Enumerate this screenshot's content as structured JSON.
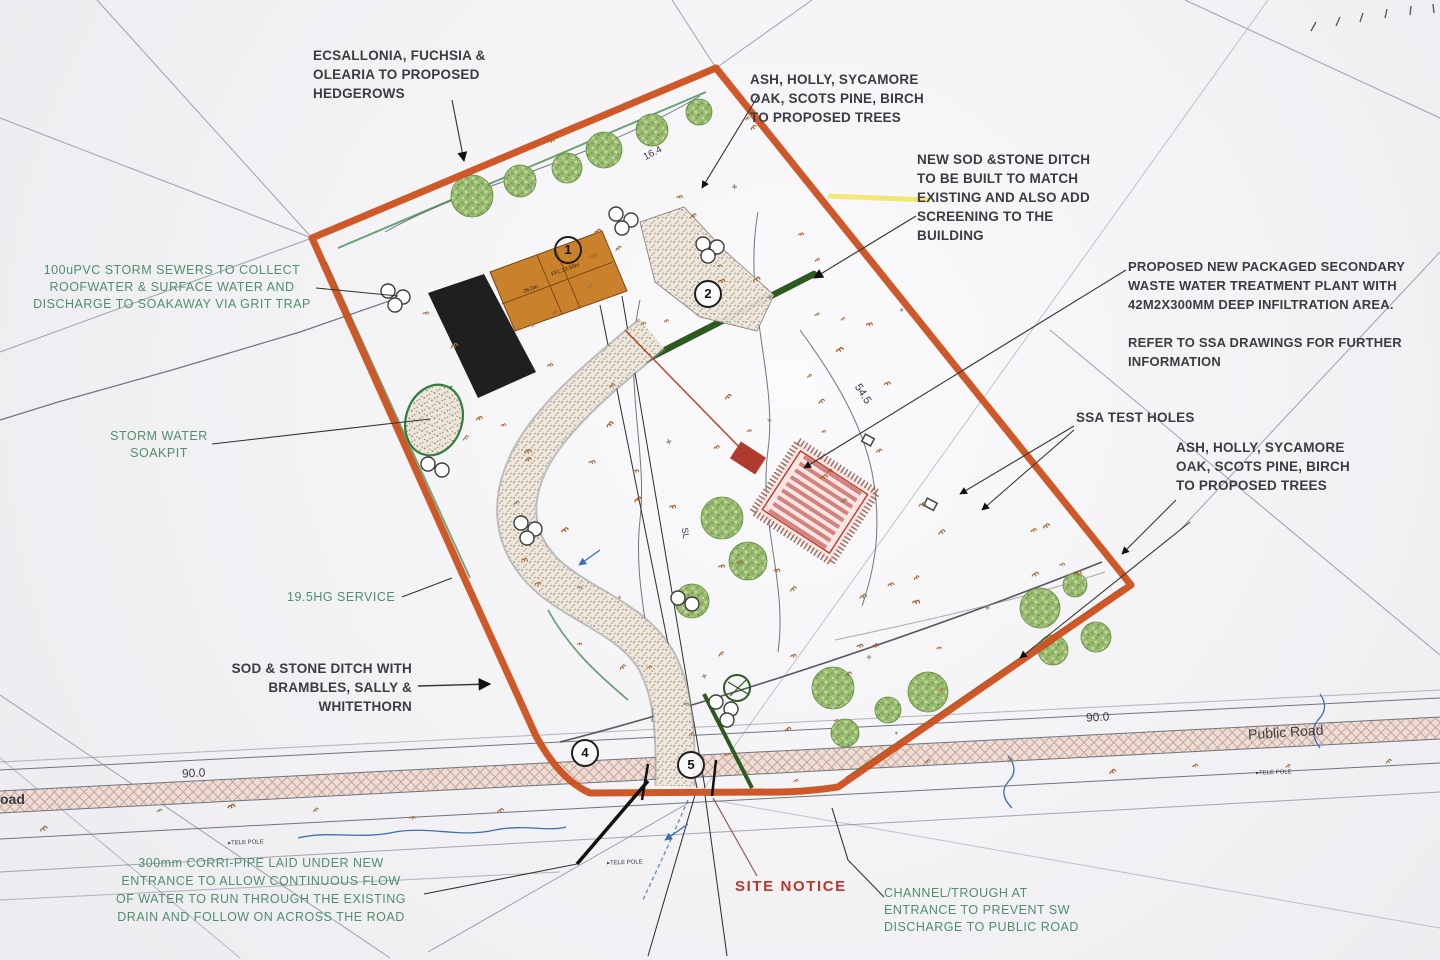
{
  "drawing": {
    "notes": {
      "hedgerows": "ECSALLONIA, FUCHSIA &\nOLEARIA TO PROPOSED\nHEDGEROWS",
      "trees_top": "ASH, HOLLY, SYCAMORE\nOAK, SCOTS PINE, BIRCH\nTO PROPOSED TREES",
      "new_sod_stone_ditch": "NEW SOD &STONE DITCH\nTO BE BUILT TO MATCH\nEXISTING AND ALSO ADD\nSCREENING TO THE\nBUILDING",
      "treatment_plant": "PROPOSED NEW PACKAGED SECONDARY\nWASTE WATER TREATMENT PLANT WITH\n42M2X300MM DEEP INFILTRATION AREA.\n\nREFER TO SSA DRAWINGS FOR FURTHER\nINFORMATION",
      "ssa_test_holes": "SSA TEST HOLES",
      "trees_right": "ASH, HOLLY, SYCAMORE\nOAK, SCOTS PINE, BIRCH\nTO PROPOSED TREES",
      "storm_sewers": "100uPVC STORM SEWERS TO COLLECT\nROOFWATER & SURFACE WATER AND\nDISCHARGE TO SOAKAWAY VIA GRIT TRAP",
      "storm_soakpit": "STORM WATER\nSOAKPIT",
      "hg_service": "19.5HG SERVICE",
      "sod_stone_ditch": "SOD & STONE DITCH WITH\nBRAMBLES, SALLY &\nWHITETHORN",
      "corri_pipe": "300mm CORRI-PIPE LAID UNDER NEW\nENTRANCE TO ALLOW CONTINUOUS FLOW\nOF WATER TO RUN THROUGH THE EXISTING\nDRAIN AND FOLLOW ON ACROSS THE ROAD",
      "site_notice": "SITE NOTICE",
      "channel_trough": "CHANNEL/TROUGH AT\nENTRANCE TO PREVENT SW\nDISCHARGE TO PUBLIC ROAD"
    },
    "labels": {
      "public_road": "Public Road",
      "road_left_partial": "oad",
      "contour_90_left": "90.0",
      "contour_90_right": "90.0",
      "spot_level_545": "54.5",
      "spot_level_164": "16.4",
      "sight_line": "SL",
      "tele_pole": "▸TELE POLE"
    },
    "refs": {
      "building": "1",
      "yard": "2",
      "field": "4",
      "entrance": "5"
    },
    "building_levels": {
      "ridge": "26.0m",
      "ffl": "FFL 23.50m"
    },
    "colors": {
      "site_boundary": "#cc4f1d",
      "proposed_building": "#c9812b",
      "annotation_green": "#4f8f6b",
      "site_notice_red": "#b5382a",
      "infiltration_red": "#c0392b"
    }
  }
}
